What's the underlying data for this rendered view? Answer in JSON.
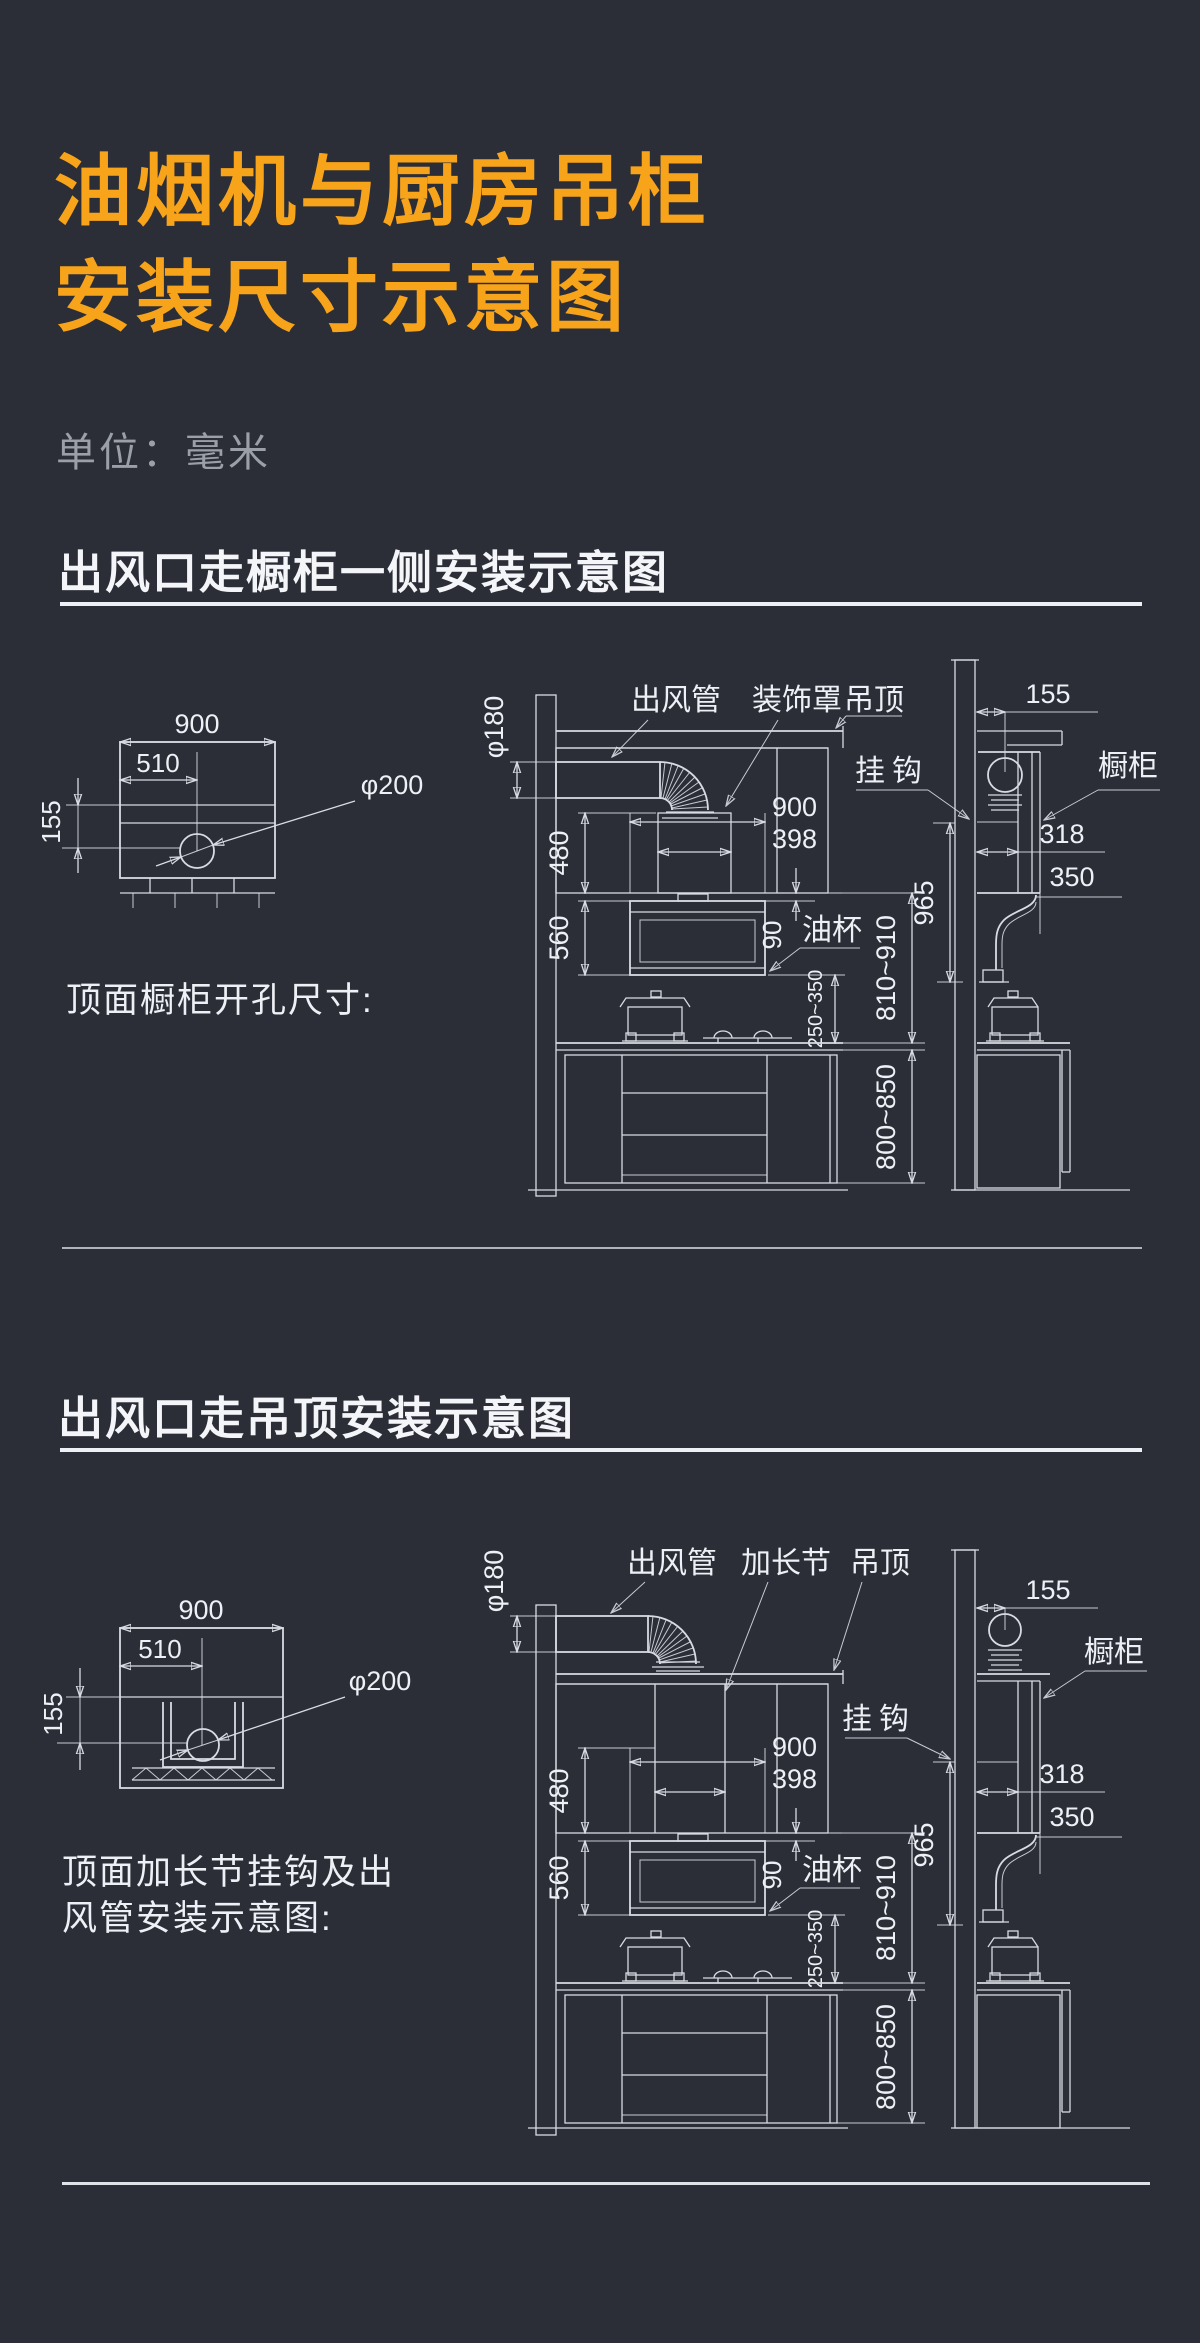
{
  "title": {
    "line1": "油烟机与厨房吊柜",
    "line2": "安装尺寸示意图",
    "unit": "单位：毫米"
  },
  "sec1": {
    "header": "出风口走橱柜一侧安装示意图",
    "caption": "顶面橱柜开孔尺寸:",
    "labels": {
      "duct": "出风管",
      "cover": "装饰罩",
      "ceiling": "吊顶",
      "hook": "挂钩",
      "cabinet": "橱柜",
      "oilcup": "油杯"
    },
    "dims": {
      "w900": "900",
      "w510": "510",
      "h155": "155",
      "d200": "φ200",
      "d180": "φ180",
      "h480": "480",
      "h560": "560",
      "w398": "398",
      "g90": "90",
      "r250": "250~350",
      "r810": "810~910",
      "r800": "800~850",
      "h965": "965",
      "side155": "155",
      "w318": "318",
      "d350": "350"
    }
  },
  "sec2": {
    "header": "出风口走吊顶安装示意图",
    "caption1": "顶面加长节挂钩及出",
    "caption2": "风管安装示意图:",
    "labels": {
      "duct": "出风管",
      "extension": "加长节",
      "ceiling": "吊顶",
      "hook": "挂钩",
      "cabinet": "橱柜",
      "oilcup": "油杯"
    },
    "dims": {
      "w900": "900",
      "w510": "510",
      "h155": "155",
      "d200": "φ200",
      "d180": "φ180",
      "h480": "480",
      "h560": "560",
      "w398": "398",
      "g90": "90",
      "r250": "250~350",
      "r810": "810~910",
      "r800": "800~850",
      "h965": "965",
      "side155": "155",
      "w318": "318",
      "d350": "350"
    }
  },
  "colors": {
    "background": "#2B2D37",
    "accent": "#F7A41B",
    "line": "#D8DCE2"
  }
}
